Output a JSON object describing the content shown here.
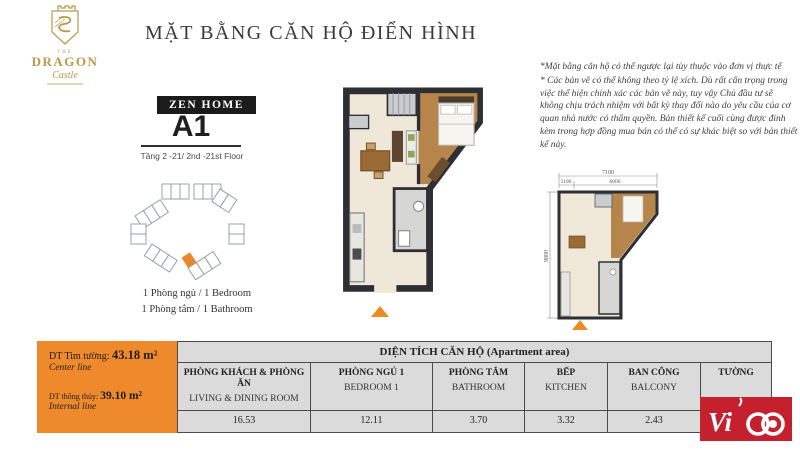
{
  "brand_logo": {
    "the": "THE",
    "name": "DRAGON",
    "sub": "Castle"
  },
  "header": {
    "title": "MẶT BẰNG CĂN HỘ ĐIỂN HÌNH"
  },
  "unit": {
    "collection": "ZEN HOME",
    "code": "A1",
    "floors": "Tầng 2 -21/ 2nd -21st Floor",
    "bedrooms": "1 Phòng ngủ / 1 Bedroom",
    "bathrooms": "1 Phòng tắm / 1 Bathroom"
  },
  "disclaimer": {
    "line1": "*Mặt bằng căn hộ có thể ngược lại tùy thuộc vào đơn vị thực tế",
    "line2": "* Các bản vẽ có thể không theo tỷ lệ xích. Dù rất cẩn trọng trong việc thể hiện chính xác các bản vẽ này, tuy vậy Chủ đầu tư sẽ không chịu trách nhiệm với bất kỳ thay đổi nào do yêu cầu của cơ quan nhà nước có thẩm quyền. Bản thiết kế cuối cùng được đính kèm trong hợp đồng mua bán có thể có sự khác biệt so với bản thiết kế này."
  },
  "plan_dimensions": {
    "total_width": "7100",
    "left_width": "1100",
    "right_width": "6000",
    "height": "9800"
  },
  "areas_summary": {
    "center_line": {
      "label": "DT Tim tường:",
      "value": "43.18 m²",
      "sub": "Center line"
    },
    "internal_line": {
      "label": "DT thông thủy:",
      "value": "39.10 m²",
      "sub": "Internal line"
    }
  },
  "areas_table": {
    "title": "DIỆN TÍCH CĂN HỘ (Apartment area)",
    "columns": [
      {
        "vi": "PHÒNG KHÁCH & PHÒNG ĂN",
        "en": "LIVING & DINING ROOM",
        "value": "16.53"
      },
      {
        "vi": "PHÒNG NGỦ 1",
        "en": "BEDROOM 1",
        "value": "12.11"
      },
      {
        "vi": "PHÒNG TẮM",
        "en": "BATHROOM",
        "value": "3.70"
      },
      {
        "vi": "BẾP",
        "en": "KITCHEN",
        "value": "3.32"
      },
      {
        "vi": "BAN CÔNG",
        "en": "BALCONY",
        "value": "2.43"
      },
      {
        "vi": "TƯỜNG",
        "en": "",
        "value": ""
      }
    ]
  },
  "vico": {
    "brand": "Vico",
    "letters": "Vi"
  },
  "colors": {
    "accent_orange": "#EE8A2C",
    "logo_gold": "#B9994C",
    "vico_red": "#C5202E",
    "table_gray": "#DCDBDB"
  }
}
